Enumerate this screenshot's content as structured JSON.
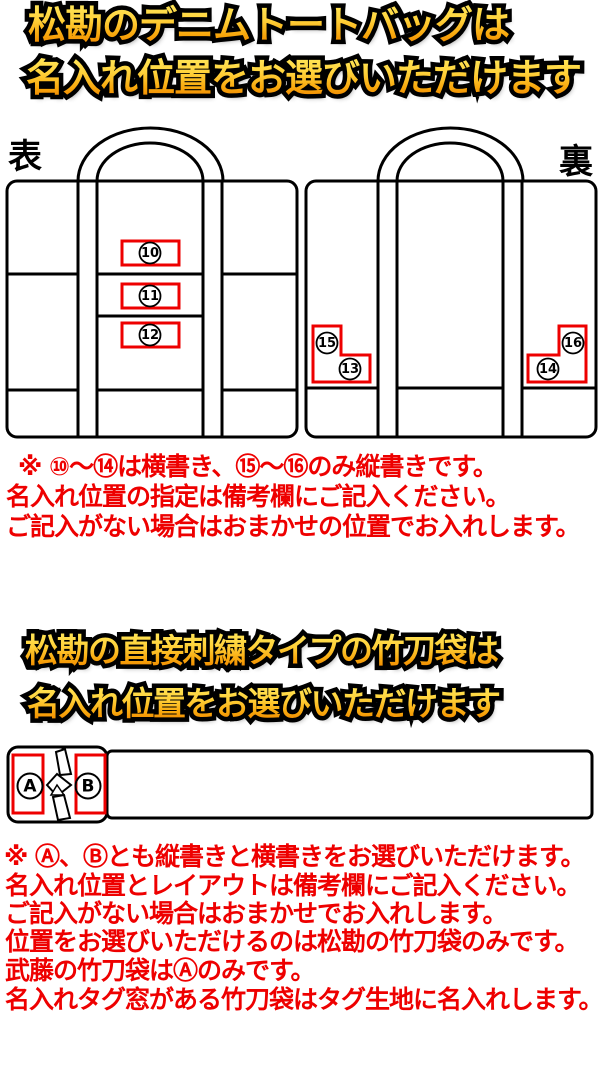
{
  "colors": {
    "accent_red": "#ee0000",
    "outline_black": "#000000",
    "title_gradient_top": "#ffe85c",
    "title_gradient_bottom": "#ee8000",
    "background": "#ffffff"
  },
  "heading_tote": {
    "line1": "松勘のデニムトートバッグは",
    "line2": "名入れ位置をお選びいただけます"
  },
  "tote_diagram": {
    "front_label": "表",
    "back_label": "裏",
    "front_positions": {
      "p10": "10",
      "p11": "11",
      "p12": "12"
    },
    "back_positions": {
      "p13": "13",
      "p14": "14",
      "p15": "15",
      "p16": "16"
    }
  },
  "tote_note": {
    "lines": [
      "※ ⑩〜⑭は横書き、⑮〜⑯のみ縦書きです。",
      "名入れ位置の指定は備考欄にご記入ください。",
      "ご記入がない場合はおまかせの位置でお入れします。"
    ]
  },
  "heading_shinai": {
    "line1": "松勘の直接刺繍タイプの竹刀袋は",
    "line2": "名入れ位置をお選びいただけます"
  },
  "shinai_diagram": {
    "position_a": "A",
    "position_b": "B"
  },
  "shinai_note": {
    "lines": [
      "※ Ⓐ、Ⓑとも縦書きと横書きをお選びいただけます。",
      "名入れ位置とレイアウトは備考欄にご記入ください。",
      "ご記入がない場合はおまかせでお入れします。",
      "位置をお選びいただけるのは松勘の竹刀袋のみです。",
      "武藤の竹刀袋はⒶのみです。",
      "名入れタグ窓がある竹刀袋はタグ生地に名入れします。"
    ]
  }
}
